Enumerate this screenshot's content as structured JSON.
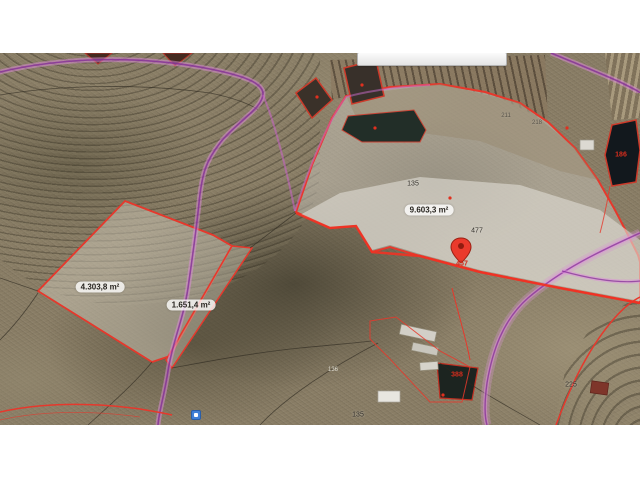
{
  "map": {
    "area_labels": [
      {
        "id": "parcel-left",
        "text": "4.303,8 m²"
      },
      {
        "id": "parcel-strip",
        "text": "1.651,4 m²"
      },
      {
        "id": "parcel-right",
        "text": "9.603,3 m²"
      }
    ],
    "parcel_numbers": [
      {
        "id": "big-parcel-upper",
        "text": "135"
      },
      {
        "id": "big-parcel-road",
        "text": "477"
      },
      {
        "id": "terrace-a",
        "text": "211"
      },
      {
        "id": "terrace-b",
        "text": "218"
      },
      {
        "id": "bottom-right-field",
        "text": "225"
      },
      {
        "id": "bottom-center-road",
        "text": "135"
      },
      {
        "id": "bottom-left-scrub",
        "text": "136"
      }
    ],
    "red_labels": [
      {
        "id": "right-pond",
        "text": "186"
      },
      {
        "id": "small-pond",
        "text": "388"
      },
      {
        "id": "marker-parcel",
        "text": "457"
      }
    ],
    "colors": {
      "parcel_outline": "#e6382c",
      "road_purple": "#8d2fa0",
      "marker_red": "#ea3a2c",
      "area_label_bg": "rgba(255,255,255,0.78)",
      "page_background": "#ffffff"
    }
  }
}
